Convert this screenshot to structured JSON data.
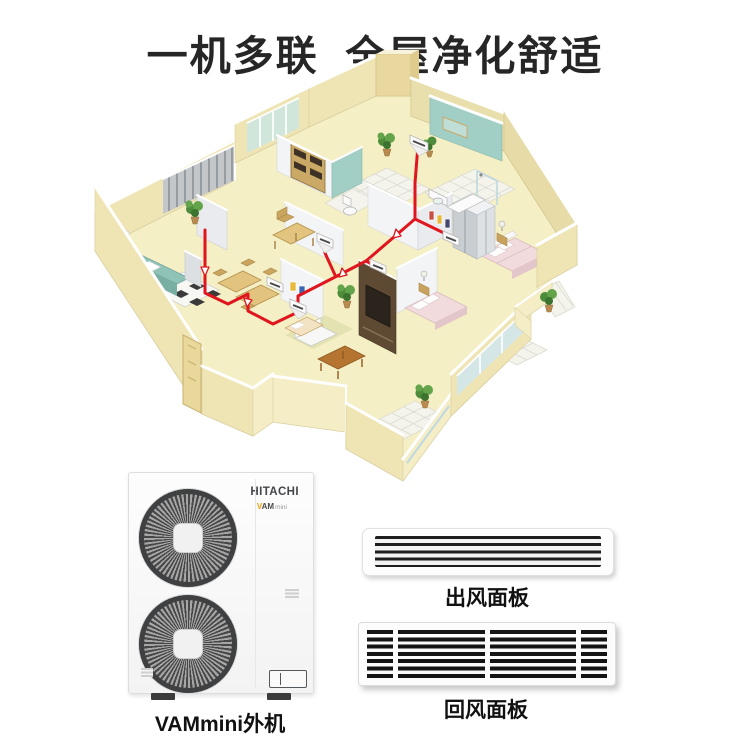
{
  "page": {
    "title": "一机多联  全屋净化舒适"
  },
  "colors": {
    "accent_red": "#E0161F",
    "title_color": "#262626",
    "brand_orange": "#F49C00",
    "wall_cream": "#EFE5B4",
    "floor_yellow": "#F6F0C6",
    "bathroom_teal": "#A2CFC5"
  },
  "outdoor_unit": {
    "brand": "HITACHI",
    "logo_v": "V",
    "logo_am": "AM",
    "logo_mini": "mini",
    "caption": "VAMmini外机"
  },
  "panels": [
    {
      "id": "outlet",
      "caption": "出风面板"
    },
    {
      "id": "return",
      "caption": "回风面板"
    }
  ]
}
